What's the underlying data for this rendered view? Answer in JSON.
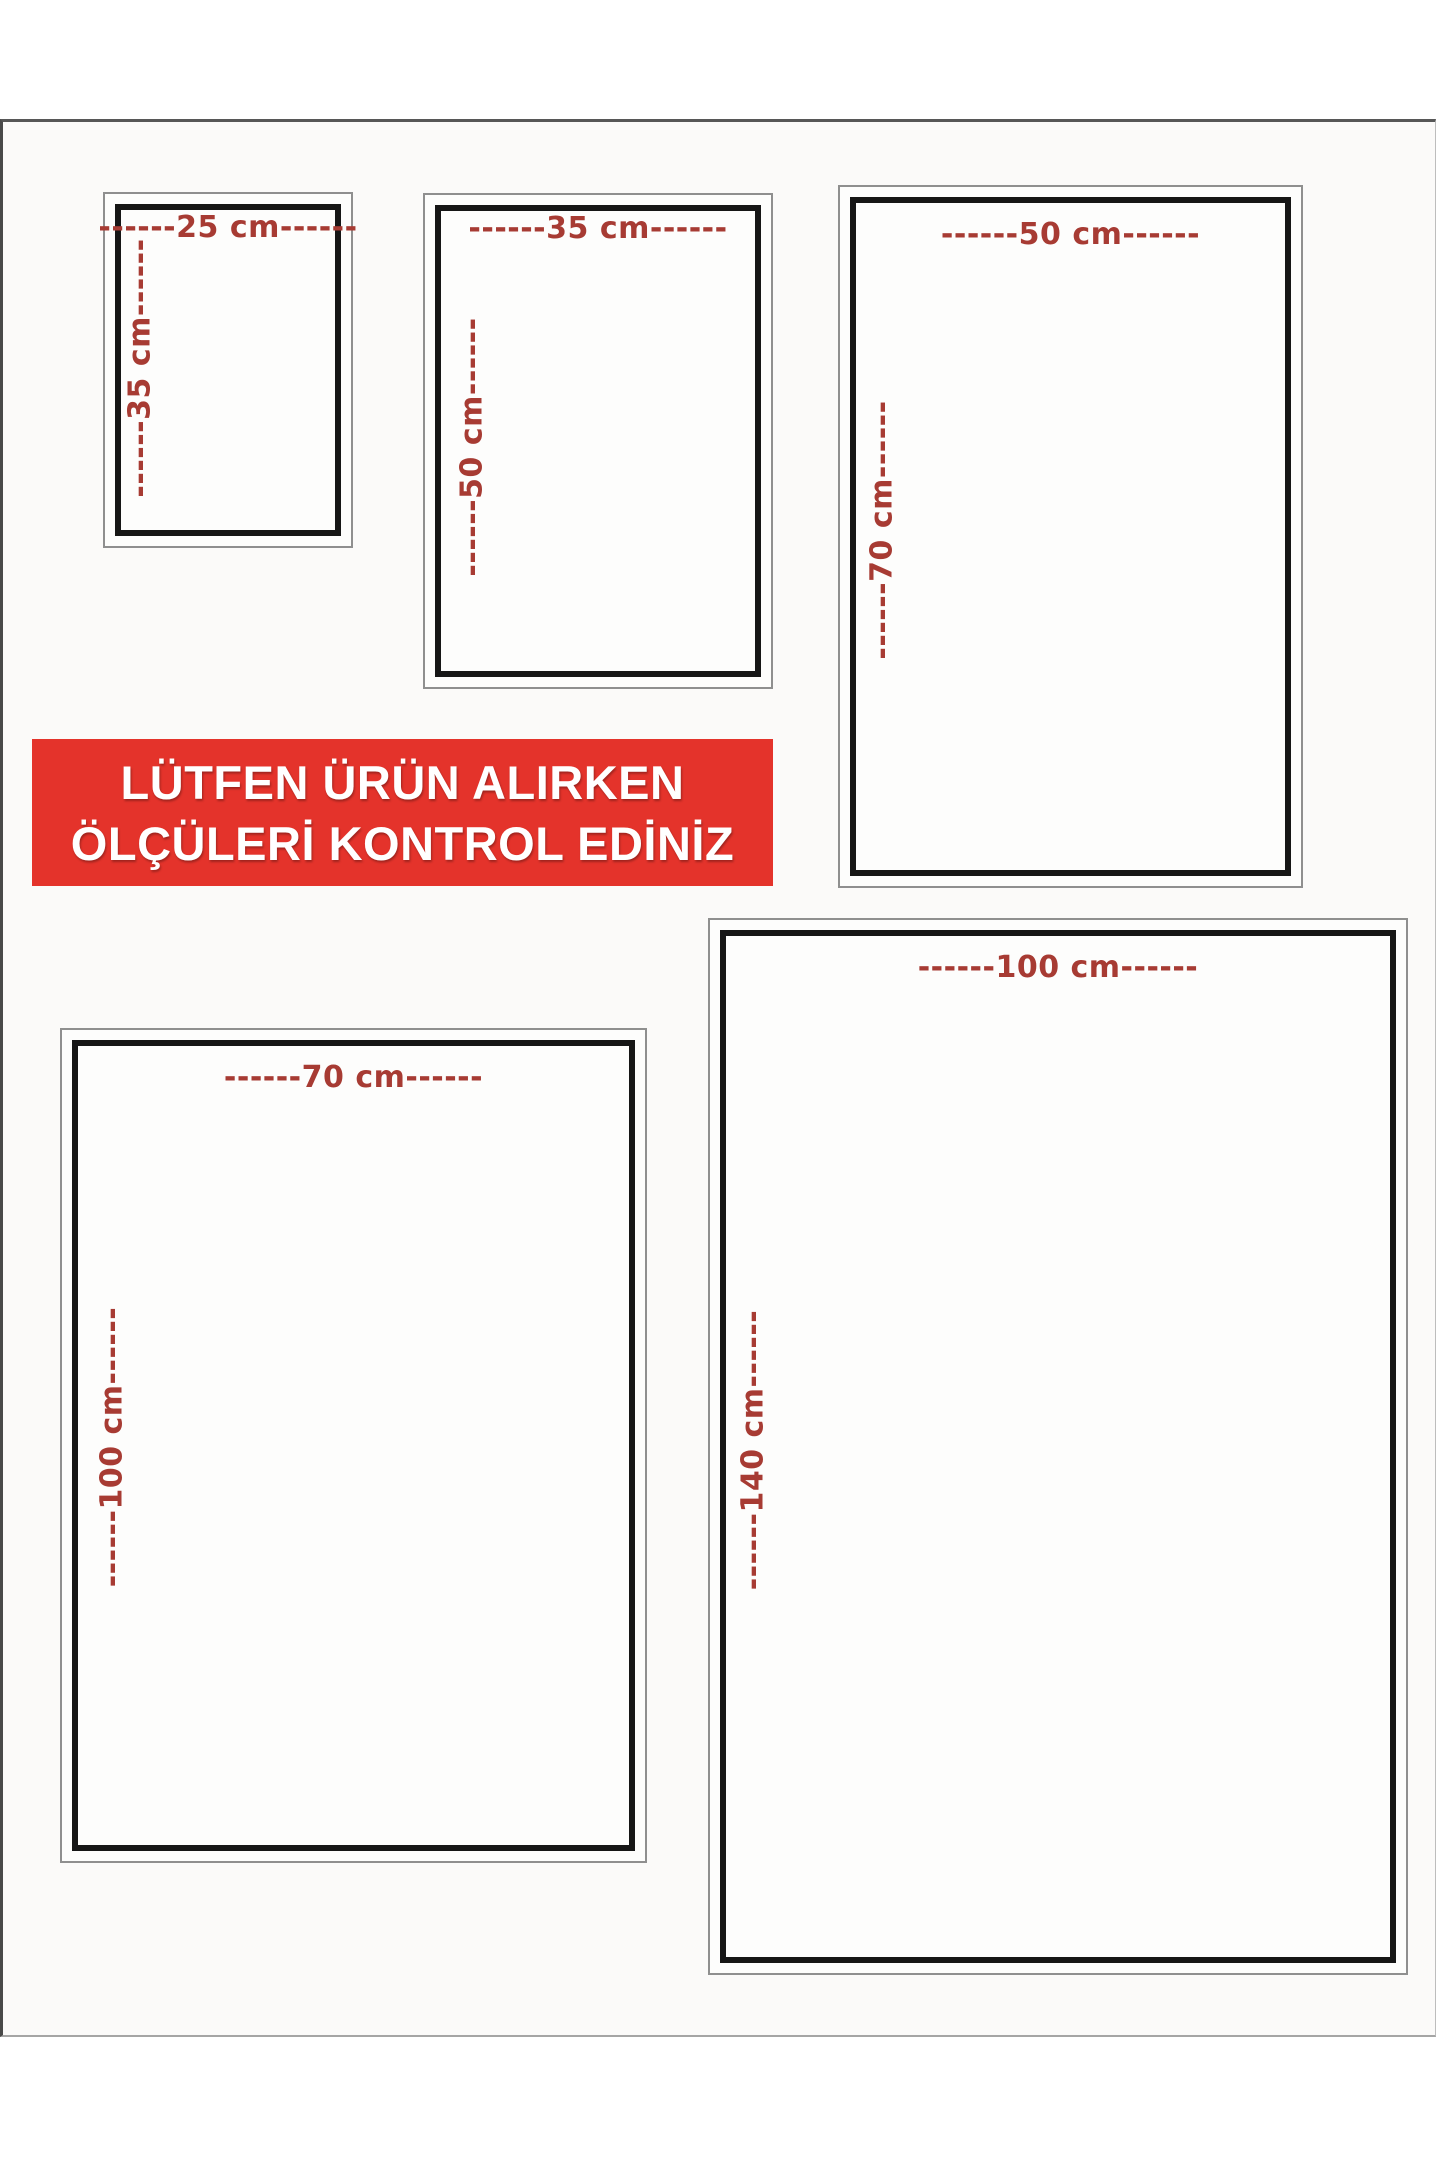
{
  "page": {
    "background": "#ffffff",
    "paper_background": "#fbfaf9",
    "paper_edge_color": "#8c8c8c"
  },
  "banner": {
    "line1": "LÜTFEN ÜRÜN ALIRKEN",
    "line2": "ÖLÇÜLERİ KONTROL EDİNİZ",
    "background": "#e4332b",
    "text_color": "#ffffff"
  },
  "label_color": "#a73b33",
  "frame": {
    "outer_color": "#8f8f8f",
    "inner_color": "#161616"
  },
  "sizes": [
    {
      "name": "25x35",
      "width_cm": 25,
      "height_cm": 35,
      "width_label": "------25 cm------",
      "height_label": "------35 cm------"
    },
    {
      "name": "35x50",
      "width_cm": 35,
      "height_cm": 50,
      "width_label": "------35 cm------",
      "height_label": "------50 cm------"
    },
    {
      "name": "50x70",
      "width_cm": 50,
      "height_cm": 70,
      "width_label": "------50 cm------",
      "height_label": "------70 cm------"
    },
    {
      "name": "70x100",
      "width_cm": 70,
      "height_cm": 100,
      "width_label": "------70 cm------",
      "height_label": "------100 cm------"
    },
    {
      "name": "100x140",
      "width_cm": 100,
      "height_cm": 140,
      "width_label": "------100 cm------",
      "height_label": "------140 cm------"
    }
  ]
}
